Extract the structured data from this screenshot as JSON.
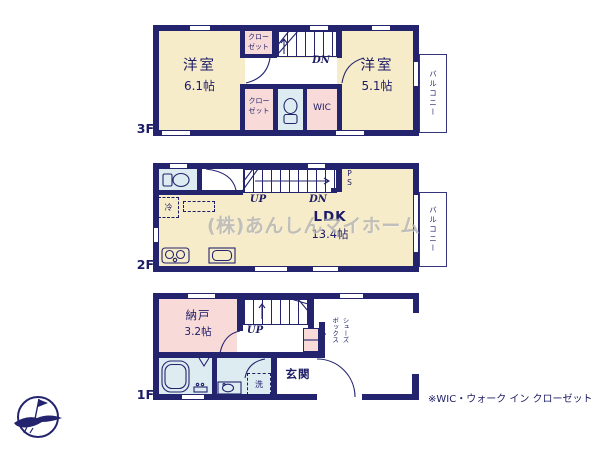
{
  "watermark": "(株)あんしんマイホーム",
  "note": "※WIC・ウォーク イン クローゼット",
  "colors": {
    "wall": "#24246e",
    "room": "#f7ecca",
    "closet": "#f8dbd8",
    "wet_area": "#dcecf1",
    "ink": "#1d1c66"
  },
  "f3": {
    "label": "3F",
    "room_left": {
      "name": "洋室",
      "size": "6.1帖"
    },
    "room_right": {
      "name": "洋室",
      "size": "5.1帖"
    },
    "closet_top": "クロー\nゼット",
    "closet_bottom": "クロー\nゼット",
    "wic": "WIC",
    "balcony": "バルコニー",
    "dn": "DN"
  },
  "f2": {
    "label": "2F",
    "ldk": {
      "name": "LDK",
      "size": "13.4帖"
    },
    "balcony": "バルコニー",
    "up": "UP",
    "dn": "DN",
    "ps": "PS",
    "fridge": "冷"
  },
  "f1": {
    "label": "1F",
    "nando": {
      "name": "納戸",
      "size": "3.2帖"
    },
    "genkan": "玄関",
    "up": "UP",
    "washer": "洗",
    "shoebox": {
      "col1": "シューズ",
      "col2": "ボックス"
    }
  }
}
